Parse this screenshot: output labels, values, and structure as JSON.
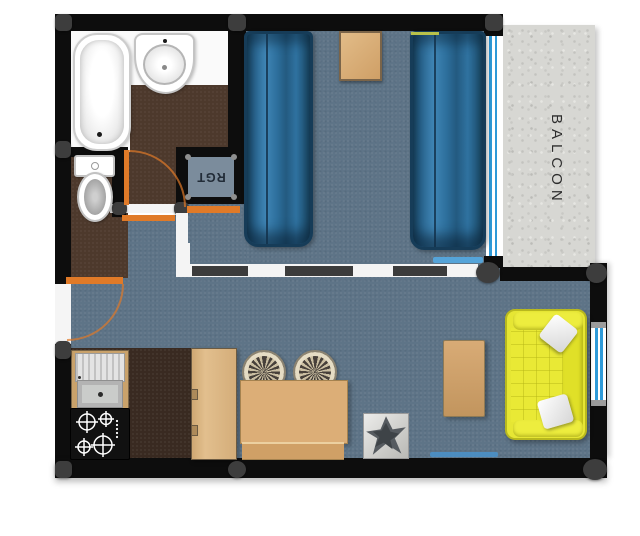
{
  "labels": {
    "balcony": "BALCON",
    "storage": "RGT"
  },
  "colors": {
    "wall": "#0d0d0d",
    "floor-blue": "#5e7487",
    "floor-brown": "#4d392c",
    "floor-darkbrown": "#392a21",
    "closet-blue": "#7b8c9c",
    "accent-orange": "#e07a28",
    "bed-border": "#163c58",
    "sofa-yellow": "#e6e634",
    "concrete": "#d7d7d3",
    "window-blue": "#2e9ad8",
    "post-gray": "#3d3d3d"
  },
  "rooms": {
    "bathroom": "bathroom",
    "wc": "wc",
    "storage_closet": "storage-closet",
    "bedroom": "bedroom",
    "living_room": "living-room",
    "kitchen_corner": "kitchen-corner",
    "balcony": "balcony"
  },
  "furniture": [
    "bathtub",
    "washbasin",
    "toilet",
    "bed",
    "bed",
    "nightstand",
    "kitchen-sink",
    "cooktop",
    "wardrobe",
    "dining-table",
    "wicker-chair",
    "wicker-chair",
    "plant",
    "coffee-table",
    "sofa"
  ]
}
